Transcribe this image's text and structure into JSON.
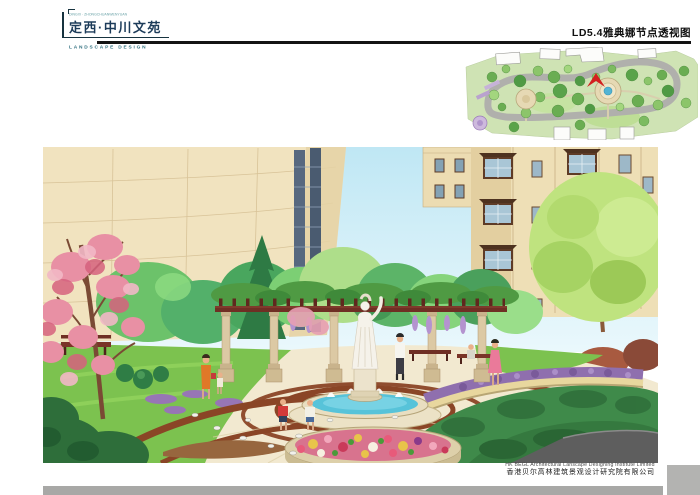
{
  "header": {
    "logo": {
      "tagline": "DINGXI · ZHONGCHUANWENYUAN",
      "title": "定西·中川文苑",
      "subtitle": "LANDSCAPE DESIGN"
    },
    "sheet_title": "LD5.4雅典娜节点透视图"
  },
  "footer": {
    "company_en": "HK BEGL Architectural Lanscape Designing Institute Limited",
    "company_cn": "香港贝尔高林建筑景观设计研究院有限公司"
  },
  "colors": {
    "rule": "#141414",
    "logo_title": "#1d3c5a",
    "logo_subtitle": "#2e6e7e",
    "footer_bar": "#a8a8a6",
    "sky": "#bfe7f4",
    "building_beige": "#f0e2bd",
    "fountain_water": "#57c3d9",
    "pergola_beam": "#6f2f24",
    "lawn_green": "#7cc24f",
    "paving_cream": "#f2e9d0",
    "paving_band_brown": "#8a4526",
    "plan_marker_red": "#d32020"
  }
}
